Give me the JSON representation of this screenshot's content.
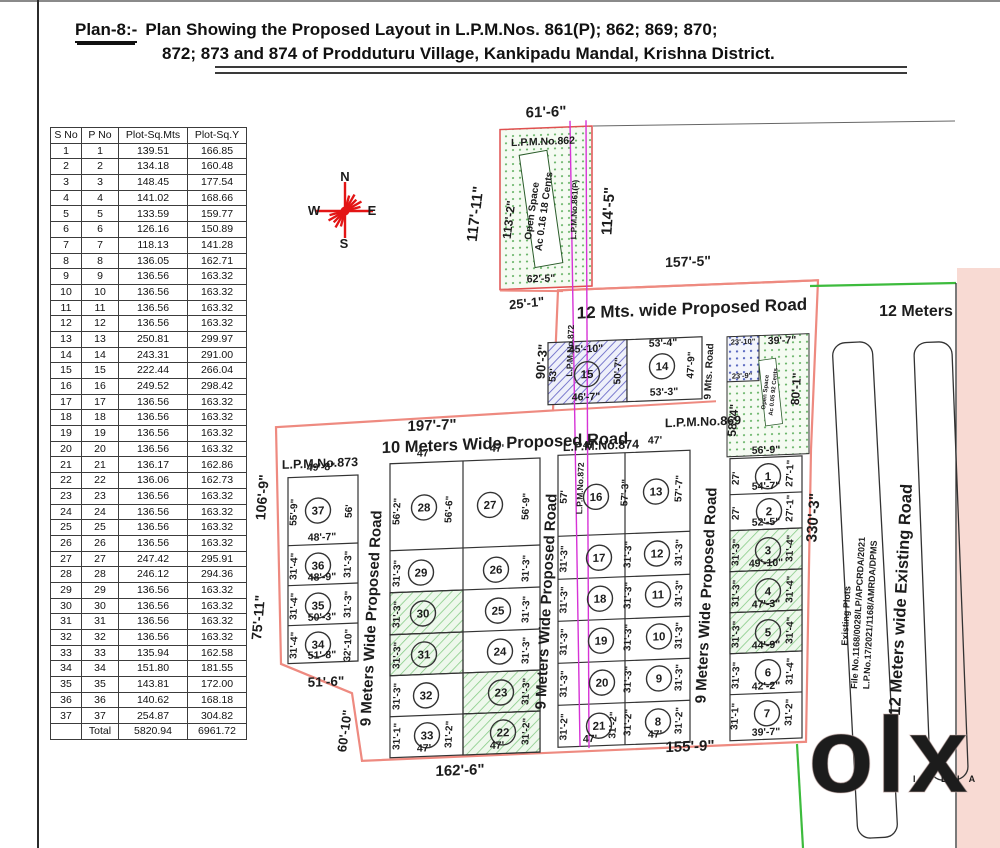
{
  "title": {
    "label": "Plan-8:-",
    "line1": "Plan Showing the Proposed Layout in L.P.M.Nos. 861(P); 862; 869; 870;",
    "line2": "872; 873 and 874 of Prodduturu Village, Kankipadu Mandal, Krishna District."
  },
  "compass": {
    "n": "N",
    "e": "E",
    "s": "S",
    "w": "W"
  },
  "watermark": {
    "logo": "olx",
    "sub": "I N D I A"
  },
  "colors": {
    "ink": "#1c1c1c",
    "red": "#d42a1e",
    "red2": "#e05a3c",
    "mag": "#c428c4",
    "boundary": "#ee8a80",
    "green_line": "#3dbb3d",
    "compass": "#e31515"
  },
  "table": {
    "headers": [
      "S No",
      "P No",
      "Plot-Sq.Mts",
      "Plot-Sq.Y"
    ],
    "rows": [
      [
        "1",
        "1",
        "139.51",
        "166.85"
      ],
      [
        "2",
        "2",
        "134.18",
        "160.48"
      ],
      [
        "3",
        "3",
        "148.45",
        "177.54"
      ],
      [
        "4",
        "4",
        "141.02",
        "168.66"
      ],
      [
        "5",
        "5",
        "133.59",
        "159.77"
      ],
      [
        "6",
        "6",
        "126.16",
        "150.89"
      ],
      [
        "7",
        "7",
        "118.13",
        "141.28"
      ],
      [
        "8",
        "8",
        "136.05",
        "162.71"
      ],
      [
        "9",
        "9",
        "136.56",
        "163.32"
      ],
      [
        "10",
        "10",
        "136.56",
        "163.32"
      ],
      [
        "11",
        "11",
        "136.56",
        "163.32"
      ],
      [
        "12",
        "12",
        "136.56",
        "163.32"
      ],
      [
        "13",
        "13",
        "250.81",
        "299.97"
      ],
      [
        "14",
        "14",
        "243.31",
        "291.00"
      ],
      [
        "15",
        "15",
        "222.44",
        "266.04"
      ],
      [
        "16",
        "16",
        "249.52",
        "298.42"
      ],
      [
        "17",
        "17",
        "136.56",
        "163.32"
      ],
      [
        "18",
        "18",
        "136.56",
        "163.32"
      ],
      [
        "19",
        "19",
        "136.56",
        "163.32"
      ],
      [
        "20",
        "20",
        "136.56",
        "163.32"
      ],
      [
        "21",
        "21",
        "136.17",
        "162.86"
      ],
      [
        "22",
        "22",
        "136.06",
        "162.73"
      ],
      [
        "23",
        "23",
        "136.56",
        "163.32"
      ],
      [
        "24",
        "24",
        "136.56",
        "163.32"
      ],
      [
        "25",
        "25",
        "136.56",
        "163.32"
      ],
      [
        "26",
        "26",
        "136.56",
        "163.32"
      ],
      [
        "27",
        "27",
        "247.42",
        "295.91"
      ],
      [
        "28",
        "28",
        "246.12",
        "294.36"
      ],
      [
        "29",
        "29",
        "136.56",
        "163.32"
      ],
      [
        "30",
        "30",
        "136.56",
        "163.32"
      ],
      [
        "31",
        "31",
        "136.56",
        "163.32"
      ],
      [
        "32",
        "32",
        "136.56",
        "163.32"
      ],
      [
        "33",
        "33",
        "135.94",
        "162.58"
      ],
      [
        "34",
        "34",
        "151.80",
        "181.55"
      ],
      [
        "35",
        "35",
        "143.81",
        "172.00"
      ],
      [
        "36",
        "36",
        "140.62",
        "168.18"
      ],
      [
        "37",
        "37",
        "254.87",
        "304.82"
      ]
    ],
    "total_label": "Total",
    "total": [
      "5820.94",
      "6961.72"
    ]
  },
  "plan": {
    "labels_sk": [
      [
        "61'-6\"",
        546,
        117,
        0,
        15
      ],
      [
        "L.P.M.No.862",
        543,
        145,
        0,
        10.5,
        "red"
      ],
      [
        "117'-11\"",
        480,
        212,
        -83,
        15
      ],
      [
        "113'-2\"",
        513,
        219,
        -83,
        12
      ],
      [
        "Open Space",
        535,
        211,
        -82,
        10
      ],
      [
        "Ac 0.16 18 Cents",
        547,
        212,
        -82,
        10
      ],
      [
        "L.P.M.No.861(P)",
        577,
        211,
        -88,
        8,
        "red2"
      ],
      [
        "114'-5\"",
        613,
        214,
        -86,
        15
      ],
      [
        "62'-5\"",
        541,
        282,
        0,
        10.5
      ],
      [
        "25'-1\"",
        527,
        307,
        -4,
        13
      ],
      [
        "157'-5\"",
        688,
        272,
        0,
        14
      ],
      [
        "12 Mts. wide Proposed Road",
        692,
        320,
        0,
        17
      ],
      [
        "90'-3\"",
        546,
        362,
        -85,
        13
      ],
      [
        "45'-10\"",
        586,
        354,
        0,
        10.5
      ],
      [
        "53'",
        556,
        376,
        -85,
        10
      ],
      [
        "46'-7\"",
        586,
        402,
        0,
        10.5
      ],
      [
        "50'-7\"",
        621,
        374,
        -87,
        10
      ],
      [
        "53'-4\"",
        663,
        351,
        0,
        10.5
      ],
      [
        "47'-9\"",
        694,
        371,
        -87,
        10
      ],
      [
        "53'-3\"",
        664,
        400,
        0,
        10.5
      ],
      [
        "9 Mts. Road",
        712,
        378,
        -87,
        10
      ],
      [
        "23'-10\"",
        743,
        352,
        0,
        7.5
      ],
      [
        "23'-9\"",
        742,
        386,
        0,
        7.5
      ],
      [
        "39'-7\"",
        782,
        353,
        0,
        10.5
      ],
      [
        "58'-4\"",
        737,
        428,
        -85,
        12
      ],
      [
        "80'-1\"",
        800,
        399,
        -86,
        12
      ],
      [
        "Open Space",
        767,
        401,
        -84,
        6
      ],
      [
        "Ac 0.05 92 Cents",
        775,
        401,
        -84,
        6
      ],
      [
        "L.P.M.No.869",
        703,
        432,
        0,
        12.5,
        "red"
      ],
      [
        "197'-7\"",
        432,
        426,
        0,
        15
      ],
      [
        "10 Meters Wide Proposed Road",
        505,
        447,
        0,
        16.5
      ],
      [
        "L.P.M.No.873",
        320,
        459,
        0,
        12.5,
        "red"
      ],
      [
        "L.P.M.No.874",
        601,
        452,
        0,
        12.5,
        "red"
      ],
      [
        "L.P.M.No.872",
        573,
        352,
        -88,
        8.5,
        "mag"
      ],
      [
        "L.P.M.No.872",
        583,
        490,
        -88,
        8.5,
        "mag"
      ],
      [
        "106'-9\"",
        267,
        487,
        -85,
        14
      ],
      [
        "75'-11\"",
        263,
        607,
        -85,
        14
      ],
      [
        "49'-8\"",
        321,
        462,
        0,
        10.5
      ],
      [
        "55'-9\"",
        297,
        503,
        -87,
        10
      ],
      [
        "56'",
        352,
        504,
        -87,
        10
      ],
      [
        "48'-7\"",
        322,
        532,
        0,
        10.5
      ],
      [
        "31'-4\"",
        297,
        557,
        -87,
        10
      ],
      [
        "31'-3\"",
        351,
        557,
        -87,
        10
      ],
      [
        "48'-9\"",
        322,
        572,
        0,
        10.5
      ],
      [
        "31'-4\"",
        297,
        597,
        -87,
        10
      ],
      [
        "31'-3\"",
        351,
        597,
        -87,
        10
      ],
      [
        "50'-3\"",
        322,
        612,
        0,
        10.5
      ],
      [
        "31'-4\"",
        297,
        636,
        -87,
        10
      ],
      [
        "32'-10\"",
        351,
        638,
        -87,
        10
      ],
      [
        "51'-8\"",
        322,
        650,
        0,
        10.5
      ],
      [
        "51'-6\"",
        326,
        678,
        0,
        13.5
      ],
      [
        "60'-10\"",
        349,
        724,
        -82,
        13
      ],
      [
        "9 Meters Wide Proposed Road",
        376,
        612,
        -87,
        15
      ],
      [
        "47'",
        424,
        452,
        0,
        10.5
      ],
      [
        "56'-2\"",
        400,
        506,
        -87,
        10
      ],
      [
        "56'-6\"",
        452,
        506,
        -87,
        10
      ],
      [
        "47'",
        497,
        450,
        0,
        10.5
      ],
      [
        "56'-9\"",
        529,
        506,
        -87,
        10
      ],
      [
        "31'-3\"",
        400,
        568,
        -87,
        10
      ],
      [
        "31'-3\"",
        400,
        609,
        -87,
        10
      ],
      [
        "31'-3\"",
        400,
        650,
        -87,
        10
      ],
      [
        "31'-3\"",
        400,
        691,
        -87,
        10
      ],
      [
        "31'-1\"",
        400,
        731,
        -87,
        10
      ],
      [
        "47'",
        424,
        747,
        0,
        10.5
      ],
      [
        "31'-2\"",
        452,
        731,
        -87,
        10
      ],
      [
        "31'-3\"",
        529,
        568,
        -87,
        10
      ],
      [
        "31'-3\"",
        529,
        609,
        -87,
        10
      ],
      [
        "31'-3\"",
        529,
        650,
        -87,
        10
      ],
      [
        "31'-3\"",
        529,
        691,
        -87,
        10
      ],
      [
        "31'-2\"",
        529,
        731,
        -87,
        10
      ],
      [
        "47'",
        497,
        747,
        0,
        10.5
      ],
      [
        "9 Meters Wide Proposed Road",
        551,
        602,
        -87,
        15
      ],
      [
        "47'",
        590,
        450,
        0,
        10.5
      ],
      [
        "57'",
        567,
        498,
        -87,
        10
      ],
      [
        "57'-3\"",
        628,
        496,
        -87,
        10
      ],
      [
        "47'",
        655,
        448,
        0,
        10.5
      ],
      [
        "57'-7\"",
        682,
        494,
        -87,
        10
      ],
      [
        "31'-3\"",
        567,
        560,
        -87,
        10
      ],
      [
        "31'-3\"",
        567,
        601,
        -87,
        10
      ],
      [
        "31'-3\"",
        567,
        643,
        -87,
        10
      ],
      [
        "31'-3\"",
        567,
        685,
        -87,
        10
      ],
      [
        "31'-2\"",
        567,
        728,
        -87,
        10
      ],
      [
        "31'-2\"",
        616,
        728,
        -87,
        10
      ],
      [
        "47'",
        590,
        744,
        0,
        10.5
      ],
      [
        "31'-3\"",
        631,
        558,
        -87,
        10
      ],
      [
        "31'-3\"",
        631,
        599,
        -87,
        10
      ],
      [
        "31'-3\"",
        631,
        641,
        -87,
        10
      ],
      [
        "31'-3\"",
        631,
        683,
        -87,
        10
      ],
      [
        "31'-2\"",
        631,
        726,
        -87,
        10
      ],
      [
        "31'-3\"",
        682,
        558,
        -87,
        10
      ],
      [
        "31'-3\"",
        682,
        599,
        -87,
        10
      ],
      [
        "31'-3\"",
        682,
        641,
        -87,
        10
      ],
      [
        "31'-3\"",
        682,
        683,
        -87,
        10
      ],
      [
        "31'-2\"",
        682,
        726,
        -87,
        10
      ],
      [
        "47'",
        655,
        742,
        0,
        10.5
      ],
      [
        "9 Meters Wide Proposed Road",
        711,
        602,
        -87,
        15
      ],
      [
        "56'-9\"",
        766,
        462,
        0,
        10.5
      ],
      [
        "27'",
        739,
        486,
        -87,
        10
      ],
      [
        "27'-1\"",
        793,
        483,
        -87,
        10
      ],
      [
        "54'-7\"",
        766,
        498,
        0,
        10.5
      ],
      [
        "27'",
        739,
        521,
        -87,
        10
      ],
      [
        "27'-1\"",
        793,
        518,
        -87,
        10
      ],
      [
        "52'-5\"",
        766,
        534,
        0,
        10.5
      ],
      [
        "31'-3\"",
        739,
        560,
        -87,
        10
      ],
      [
        "31'-4\"",
        793,
        558,
        -87,
        10
      ],
      [
        "49'-10\"",
        766,
        575,
        0,
        10.5
      ],
      [
        "31'-3\"",
        739,
        601,
        -87,
        10
      ],
      [
        "31'-4\"",
        793,
        599,
        -87,
        10
      ],
      [
        "47'-3\"",
        766,
        616,
        0,
        10.5
      ],
      [
        "31'-3\"",
        739,
        642,
        -87,
        10
      ],
      [
        "31'-4\"",
        793,
        640,
        -87,
        10
      ],
      [
        "44'-9\"",
        766,
        657,
        0,
        10.5
      ],
      [
        "31'-3\"",
        739,
        683,
        -87,
        10
      ],
      [
        "31'-4\"",
        793,
        681,
        -87,
        10
      ],
      [
        "42'-2\"",
        766,
        698,
        0,
        10.5
      ],
      [
        "31'-1\"",
        738,
        724,
        -87,
        10
      ],
      [
        "31'-2\"",
        792,
        722,
        -87,
        10
      ],
      [
        "39'-7\"",
        766,
        744,
        0,
        10.5
      ],
      [
        "162'-6\"",
        460,
        772,
        0,
        15
      ],
      [
        "155'-9\"",
        690,
        757,
        0,
        15
      ]
    ],
    "labels_abs": [
      [
        "12 Meters",
        916,
        316,
        0,
        16
      ],
      [
        "330'-3\"",
        818,
        518,
        -86,
        15
      ],
      [
        "Existing Plots",
        849,
        616,
        -87,
        9
      ],
      [
        "File No.1168/0028/LP/APCRDA/2021",
        861,
        613,
        -87,
        9
      ],
      [
        "L.P.No.17/2021/1168/AMRDA/DPMS",
        873,
        615,
        -87,
        9
      ],
      [
        "12 Meters  wide  Existing  Road",
        906,
        600,
        -87,
        16.5
      ]
    ],
    "plots": [
      {
        "n": "15",
        "x": 587,
        "y": 376
      },
      {
        "n": "14",
        "x": 662,
        "y": 371
      },
      {
        "n": "37",
        "x": 318,
        "y": 502
      },
      {
        "n": "36",
        "x": 318,
        "y": 557
      },
      {
        "n": "35",
        "x": 318,
        "y": 597
      },
      {
        "n": "34",
        "x": 318,
        "y": 636
      },
      {
        "n": "28",
        "x": 424,
        "y": 503
      },
      {
        "n": "29",
        "x": 421,
        "y": 568
      },
      {
        "n": "30",
        "x": 423,
        "y": 609
      },
      {
        "n": "31",
        "x": 424,
        "y": 650
      },
      {
        "n": "32",
        "x": 426,
        "y": 691
      },
      {
        "n": "33",
        "x": 427,
        "y": 731
      },
      {
        "n": "27",
        "x": 490,
        "y": 503
      },
      {
        "n": "26",
        "x": 496,
        "y": 568
      },
      {
        "n": "25",
        "x": 498,
        "y": 609
      },
      {
        "n": "24",
        "x": 500,
        "y": 650
      },
      {
        "n": "23",
        "x": 501,
        "y": 691
      },
      {
        "n": "22",
        "x": 503,
        "y": 731
      },
      {
        "n": "16",
        "x": 596,
        "y": 499
      },
      {
        "n": "17",
        "x": 599,
        "y": 560
      },
      {
        "n": "18",
        "x": 600,
        "y": 601
      },
      {
        "n": "19",
        "x": 601,
        "y": 643
      },
      {
        "n": "20",
        "x": 602,
        "y": 685
      },
      {
        "n": "21",
        "x": 599,
        "y": 728
      },
      {
        "n": "13",
        "x": 656,
        "y": 496
      },
      {
        "n": "12",
        "x": 657,
        "y": 558
      },
      {
        "n": "11",
        "x": 658,
        "y": 599
      },
      {
        "n": "10",
        "x": 659,
        "y": 641
      },
      {
        "n": "9",
        "x": 659,
        "y": 683
      },
      {
        "n": "8",
        "x": 658,
        "y": 726
      },
      {
        "n": "1",
        "x": 768,
        "y": 485
      },
      {
        "n": "2",
        "x": 769,
        "y": 520
      },
      {
        "n": "3",
        "x": 768,
        "y": 559
      },
      {
        "n": "4",
        "x": 768,
        "y": 600
      },
      {
        "n": "5",
        "x": 768,
        "y": 641
      },
      {
        "n": "6",
        "x": 768,
        "y": 681
      },
      {
        "n": "7",
        "x": 767,
        "y": 722
      }
    ]
  }
}
